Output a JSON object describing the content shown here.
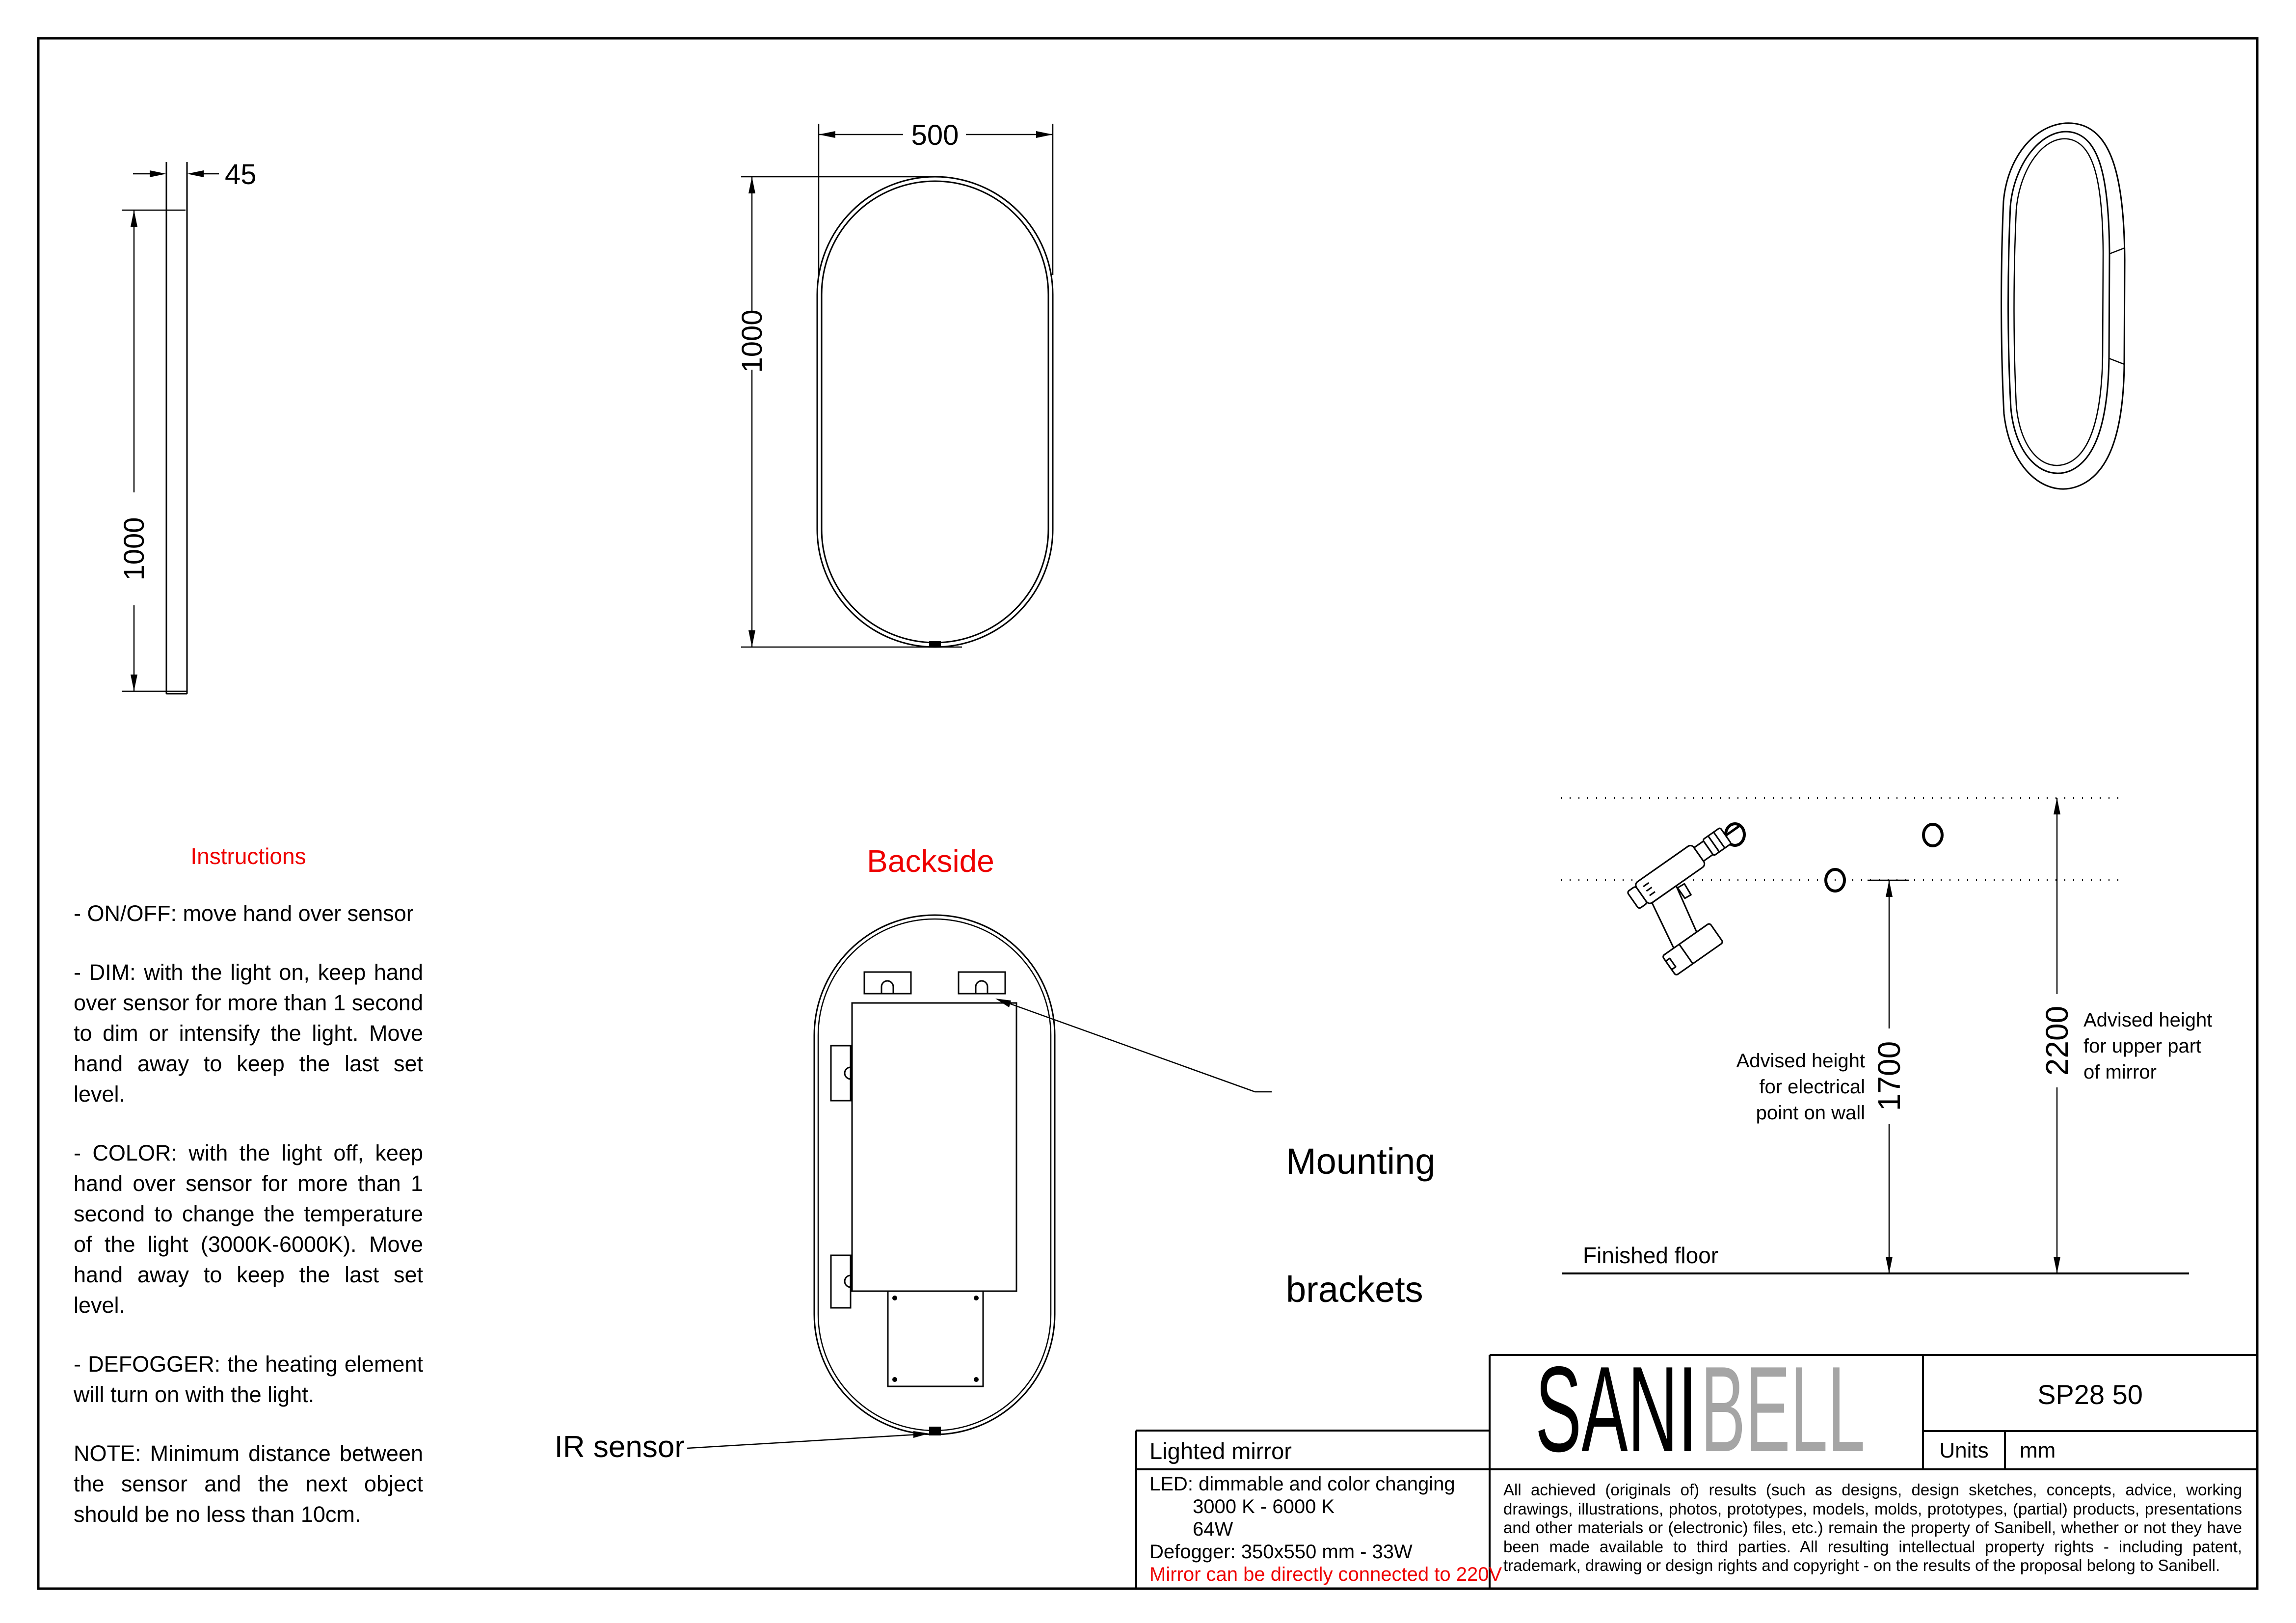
{
  "colors": {
    "accent_red": "#ee0000",
    "logo_gray": "#a5a5a5",
    "line_black": "#000000"
  },
  "side_view": {
    "thickness_dim": "45",
    "height_dim": "1000"
  },
  "front_view": {
    "width_dim": "500",
    "height_dim": "1000"
  },
  "backside_view": {
    "title": "Backside",
    "mounting_label_line1": "Mounting",
    "mounting_label_line2": "brackets",
    "ir_label": "IR sensor"
  },
  "instructions": {
    "title": "Instructions",
    "paragraphs": [
      "- ON/OFF: move hand over sensor",
      "- DIM: with the light on, keep hand over sensor for more than 1 second to dim or intensify the light. Move hand away to keep the last set level.",
      "- COLOR: with the light off, keep hand over sensor for more than 1 second to change the temperature of the light (3000K-6000K). Move hand away to keep the last set level.",
      "- DEFOGGER: the heating element will turn on with the light.",
      "NOTE: Minimum distance between the sensor and the next object should be no less than 10cm."
    ]
  },
  "mounting_diagram": {
    "height_electrical": "1700",
    "height_mirror": "2200",
    "electrical_label": [
      "Advised height",
      "for electrical",
      "point on wall"
    ],
    "mirror_label": [
      "Advised height",
      "for upper part",
      "of mirror"
    ],
    "floor_label": "Finished floor"
  },
  "title_block": {
    "product": "Lighted mirror",
    "logo_black": "SANI",
    "logo_gray": "BELL",
    "model": "SP28 50",
    "units_label": "Units",
    "units_value": "mm",
    "led_line": "LED: dimmable and color changing",
    "temp_line": "3000 K - 6000 K",
    "watt_line": "64W",
    "defogger_line": "Defogger: 350x550 mm - 33W",
    "warning_line": "Mirror can be directly connected to 220V",
    "legal": "All achieved (originals of) results (such as designs, design sketches, concepts, advice, working drawings, illustrations, photos, prototypes, models, molds, prototypes, (partial) products, presentations and other materials or (electronic) files, etc.) remain the property of Sanibell, whether or not they have been made available to third parties. All resulting intellectual property rights - including patent, trademark, drawing or design rights and copyright - on the results of the proposal belong to Sanibell."
  }
}
